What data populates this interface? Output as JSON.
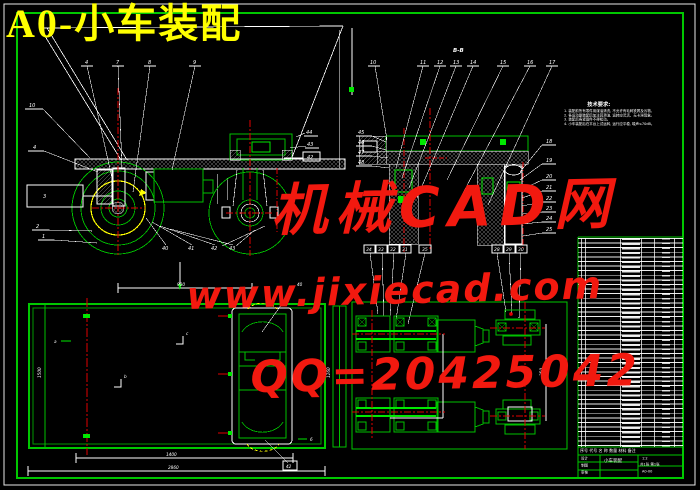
{
  "palette": {
    "background": "#000000",
    "frame_white": "#e8e8e8",
    "border_green": "#00c800",
    "bright_green": "#00e800",
    "centerline_red": "#e00000",
    "highlight_yellow": "#ffff00",
    "watermark_red": "#f2190f"
  },
  "title": "A0-小车装配",
  "watermark": {
    "line1": "机械CAD网",
    "line2": "www.jixiecad.com",
    "line3": "QQ=20425042"
  },
  "tech_notes": {
    "heading": "技术要求:",
    "lines": [
      "1. 装配前所有零件用煤油清洗, 不允许有毛刺铁屑及污物。",
      "2. 各运动副装配后加注润滑油, 运转应灵活、无卡滞现象。",
      "3. 装配后各紧固件不得松动。",
      "4. 小车装配后在平台上试运转, 运行应平稳, 噪声≤70dB。"
    ]
  },
  "front_view": {
    "callouts_top": [
      "4",
      "7",
      "8",
      "9"
    ],
    "callouts_left": [
      "10",
      "4",
      "3",
      "2",
      "1"
    ],
    "callouts_bottom": [
      "40",
      "41",
      "42",
      "43"
    ],
    "callouts_right": [
      "44",
      "43",
      "42"
    ]
  },
  "section_view": {
    "label": "B-B",
    "callout_far_left": "10",
    "callouts_top": [
      "11",
      "12",
      "13",
      "14",
      "15",
      "16",
      "17"
    ],
    "callouts_left": [
      "45",
      "46",
      "47",
      "48"
    ],
    "callouts_right": [
      "18",
      "19",
      "20",
      "21",
      "22",
      "23",
      "24",
      "25"
    ]
  },
  "plan_view": {
    "dim_top": "900",
    "dim_left": "1500",
    "dim_right": "1260",
    "dim_inner": "1400",
    "dim_overall": "2860",
    "label_a": "a",
    "label_b": "b",
    "label_c": "c",
    "label_strip": "6",
    "leader_top": "40",
    "leader_bottom": "42"
  },
  "bottom_view": {
    "callouts_left": [
      "34",
      "33",
      "32",
      "31"
    ],
    "callout_mid": "35",
    "callouts_right": [
      "28",
      "29",
      "30"
    ],
    "dim_shaft": "350"
  },
  "bom": {
    "header": "序号  代号  名 称  数量  材料  备注",
    "title_block": {
      "row1": "设计",
      "row2": "制图",
      "row3": "审核",
      "name": "小车装配",
      "scale": "1:2",
      "sheet": "共1张 第1张",
      "code": "A0-00"
    }
  }
}
